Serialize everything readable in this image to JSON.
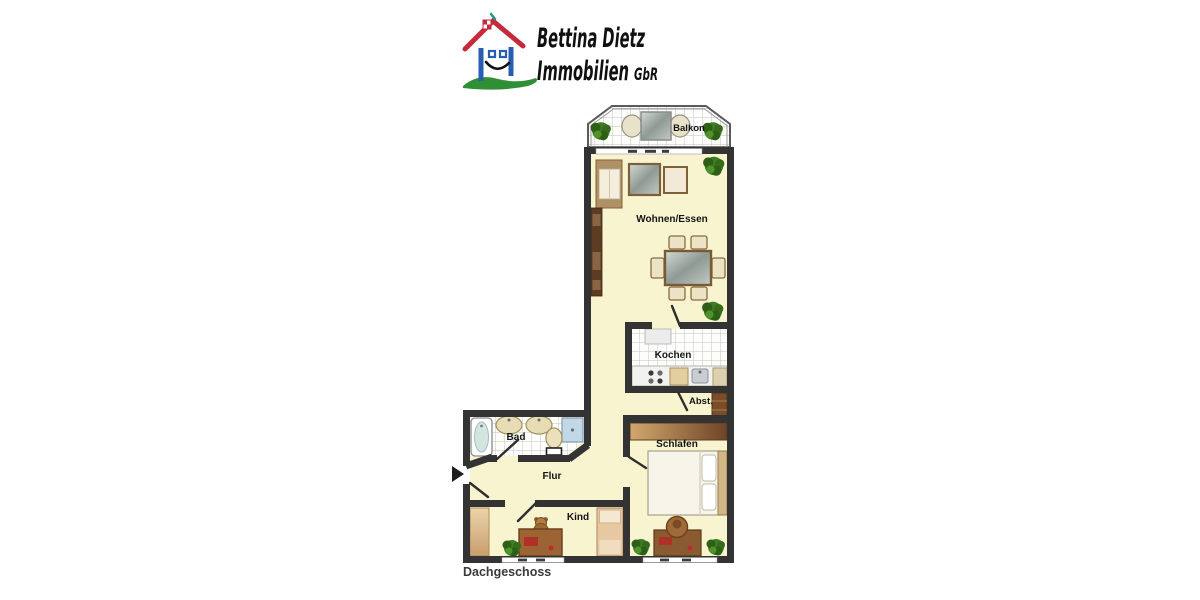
{
  "page": {
    "background": "#ffffff"
  },
  "logo": {
    "line1": "Bettina Dietz",
    "line2": "Immobilien",
    "suffix": "GbR",
    "colors": {
      "roof_red": "#c5293c",
      "wall_blue": "#2a5cb0",
      "grass_green": "#2e8f35",
      "text": "#101010"
    }
  },
  "floorplan": {
    "title": "Dachgeschoss",
    "rooms": {
      "balkon": "Balkon",
      "wohnen_essen": "Wohnen/Essen",
      "kochen": "Kochen",
      "abstellraum": "Abst.",
      "bad": "Bad",
      "flur": "Flur",
      "schlafen": "Schlafen",
      "kind": "Kind"
    },
    "colors": {
      "wall": "#333333",
      "floor": "#f8f4d0",
      "tile_line": "#c4c4c4",
      "wood_dark": "#8a5a30",
      "plant_green": "#3f7d22"
    }
  }
}
